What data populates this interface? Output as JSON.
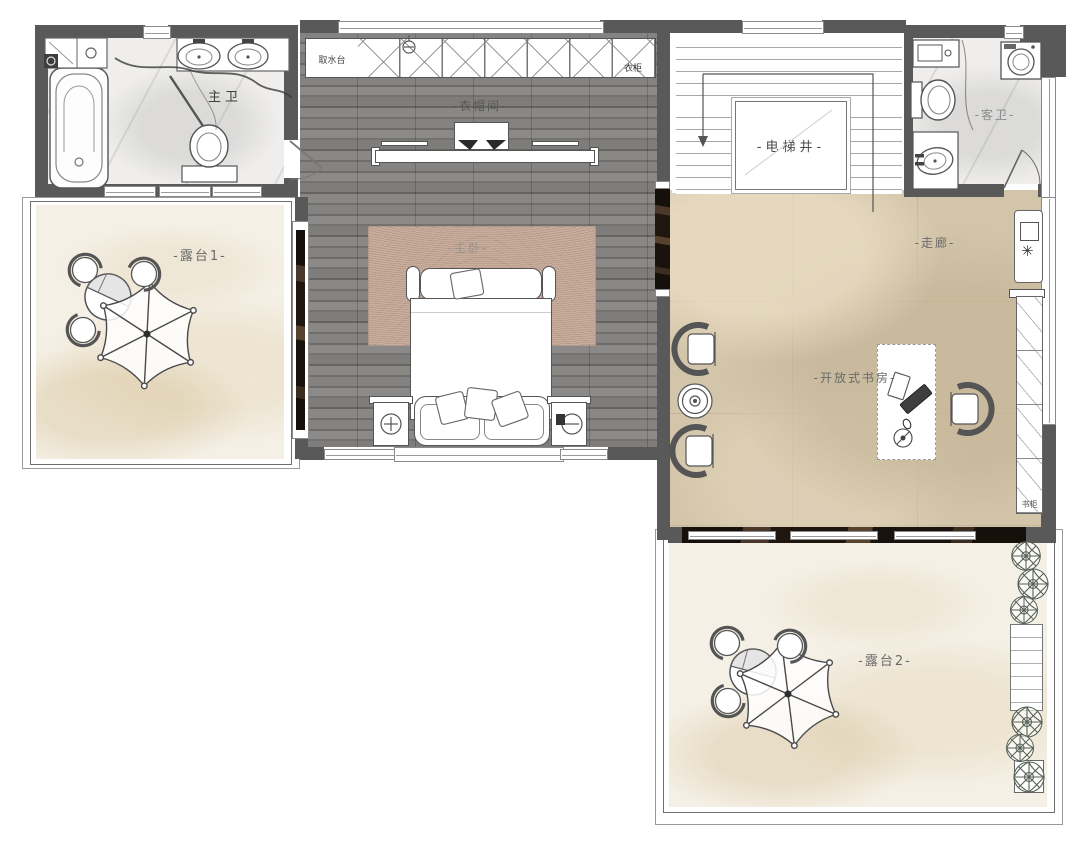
{
  "rooms": {
    "master_bath": "主卫",
    "closet": "-衣帽间-",
    "water_counter": "取水台",
    "wardrobe": "衣柜",
    "elevator_shaft": "-电梯井-",
    "guest_bath": "-客卫-",
    "terrace1": "-露台1-",
    "master_bedroom": "-主卧-",
    "corridor": "-走廊-",
    "open_study": "-开放式书房-",
    "terrace2": "-露台2-",
    "bookcase": "书柜"
  },
  "icons": {
    "snowflake": "✳"
  },
  "colors": {
    "wall": "#595959",
    "wood_floor": "#797775",
    "marble_beige": "#d3c5aa",
    "marble_cream": "#f5f0e6",
    "marble_white": "#efeeec",
    "dark_sill": "#241c18"
  }
}
